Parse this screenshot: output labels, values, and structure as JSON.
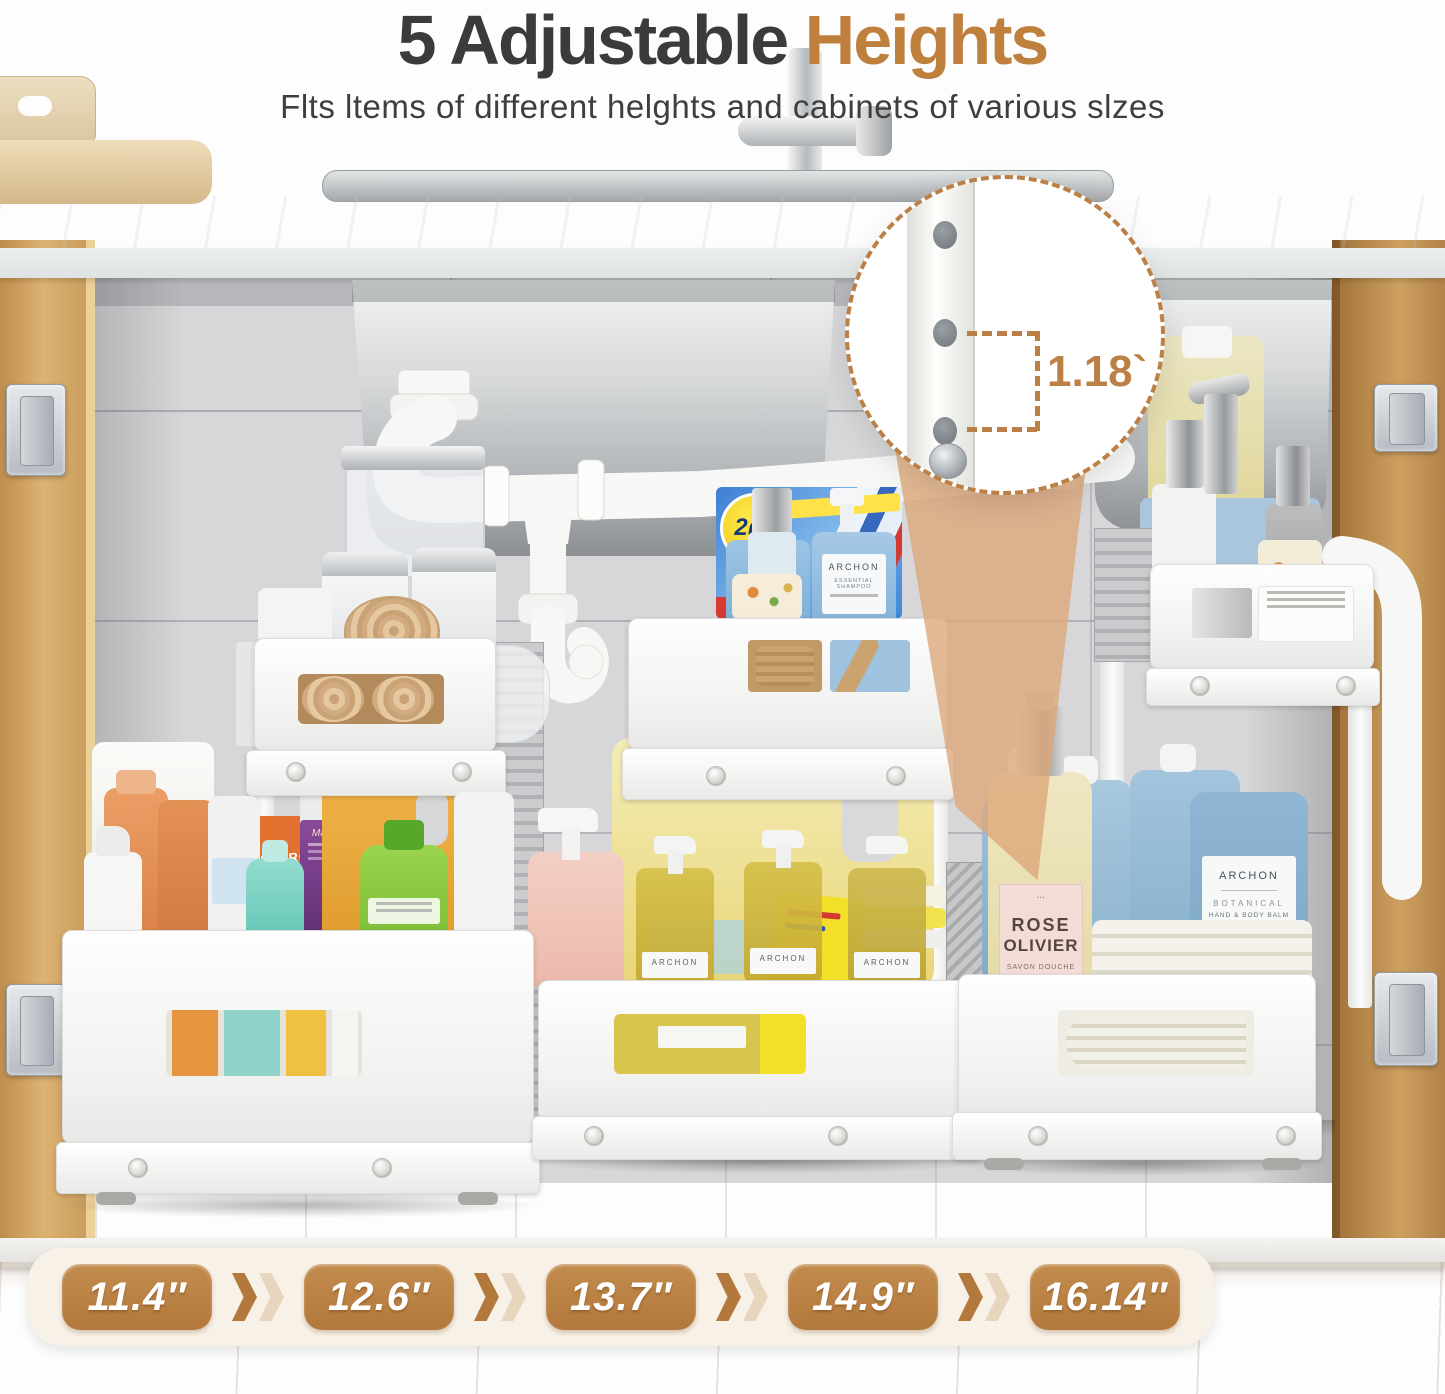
{
  "header": {
    "title_prefix": "5 Adjustable",
    "title_accent": "Heights",
    "subtitle": "Flts ltems of different helghts and cabinets of various slzes"
  },
  "callout": {
    "measurement": "1.18`"
  },
  "sizes": [
    "11.4″",
    "12.6″",
    "13.7″",
    "14.9″",
    "16.14″"
  ],
  "icons": {
    "separator": "double-chevron-right",
    "callout_border": "dashed-circle"
  },
  "products": {
    "box_2in1": "2в1",
    "shampoo_brand": "ARCHON",
    "shampoo_line": "ESSENTIAL SHAMPOO",
    "balm_brand": "ARCHON",
    "balm_line1": "BOTANICAL",
    "balm_line2": "HAND & BODY BALM",
    "balm_line3": "LAVANDIN SWEET ORANGE JASMINE",
    "rose_line1": "ROSE",
    "rose_line2": "OLIVIER",
    "rose_line3": "SAVON DOUCHE",
    "detergent": "DETERGENT",
    "mabels": "Mabel's",
    "archon_small": "ARCHON"
  },
  "colors": {
    "accent_brown": "#c0803d",
    "badge_brown": "#b3783b",
    "banner_cream": "#f7f1e8",
    "title_dark": "#3b3b3b",
    "wood": "#d0a263",
    "blue_bottle": "#8fb6d4"
  }
}
